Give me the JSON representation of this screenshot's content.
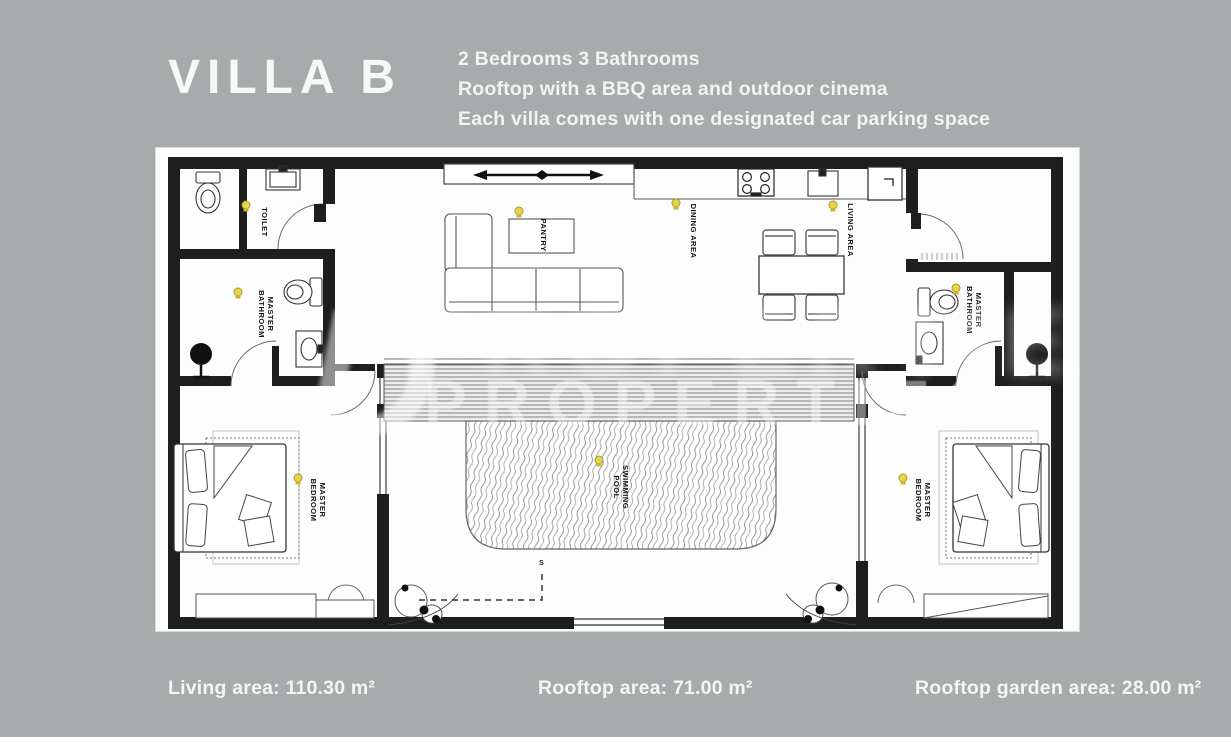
{
  "page": {
    "background": "#a8abac"
  },
  "header": {
    "title": "VILLA B",
    "features": [
      "2 Bedrooms 3 Bathrooms",
      "Rooftop with a BBQ area and outdoor cinema",
      "Each villa comes with one designated car parking space"
    ]
  },
  "floorplan": {
    "labels": {
      "toilet": "TOILET",
      "master": "MASTER",
      "bathroom": "BATHROOM",
      "bedroom": "BEDROOM",
      "pantry": "PANTRY",
      "dining_area": "DINING AREA",
      "living_area": "LIVING AREA",
      "swimming": "SWIMMING",
      "pool": "POOL",
      "stairs_marker": "S"
    },
    "watermark": {
      "glyph": "D",
      "text": "PROPERTIES"
    },
    "colors": {
      "wall": "#1e1e1e",
      "lamp_yellow": "#e8d44a"
    }
  },
  "footer": {
    "areas": [
      "Living area: 110.30 m²",
      "Rooftop area: 71.00 m²",
      "Rooftop garden area: 28.00 m²"
    ]
  }
}
